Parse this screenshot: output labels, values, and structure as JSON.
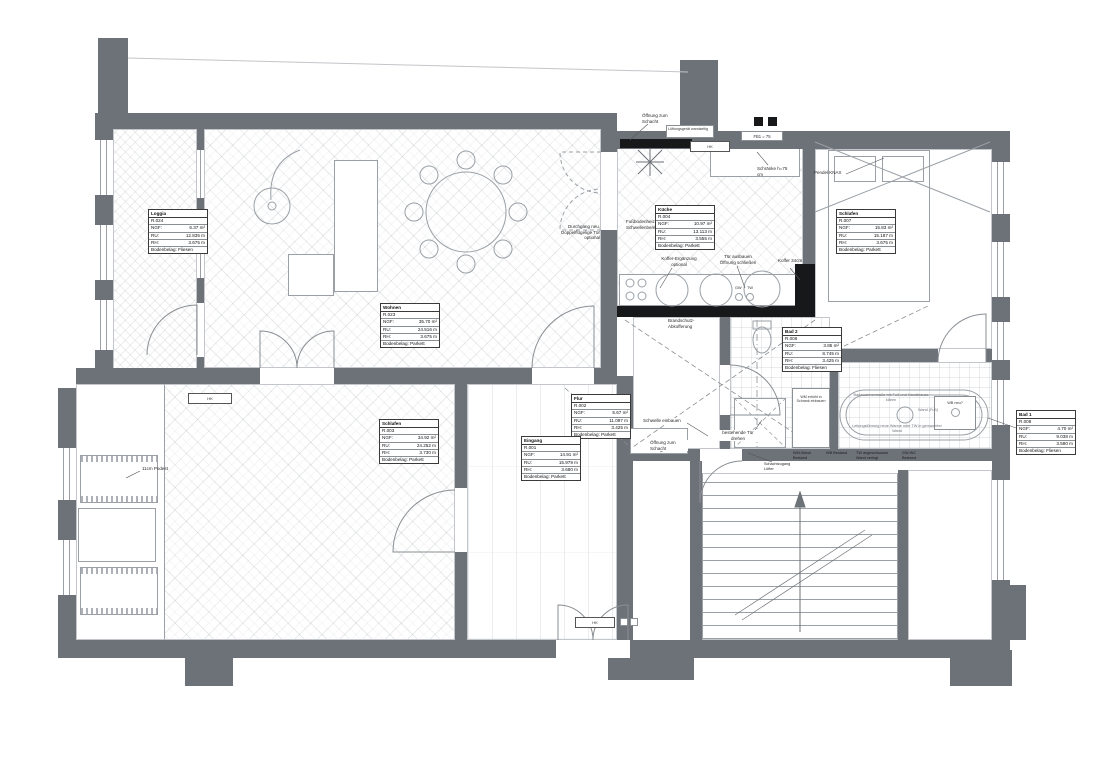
{
  "drawing": {
    "type": "floor-plan",
    "language": "de",
    "wall_color": "#6d7178",
    "accent_black": "#17181a"
  },
  "metrics_labels": {
    "ngf": "NGF:",
    "ru": "RU:",
    "rh": "RH:"
  },
  "rooms": [
    {
      "name": "Loggia",
      "number": "R.024",
      "ngf": "6.37 m²",
      "ru": "12.835 m",
      "rh": "3.675 m",
      "floor": "Bodenbelag: Fliesen"
    },
    {
      "name": "Wohnen",
      "number": "R.023",
      "ngf": "35.70 m²",
      "ru": "24.516 m",
      "rh": "3.675 m",
      "floor": "Bodenbelag: Parkett"
    },
    {
      "name": "Küche",
      "number": "R.004",
      "ngf": "10.97 m²",
      "ru": "13.113 m",
      "rh": "3.555 m",
      "floor": "Bodenbelag: Parkett"
    },
    {
      "name": "Schlafen",
      "number": "R.007",
      "ngf": "15.83 m²",
      "ru": "15.187 m",
      "rh": "3.675 m",
      "floor": "Bodenbelag: Parkett"
    },
    {
      "name": "Bad 2",
      "number": "R.006",
      "ngf": "3.85 m²",
      "ru": "8.745 m",
      "rh": "3.425 m",
      "floor": "Bodenbelag: Fliesen"
    },
    {
      "name": "Flur",
      "number": "R.002",
      "ngf": "5.67 m²",
      "ru": "11.097 m",
      "rh": "3.425 m",
      "floor": "Bodenbelag: Parkett"
    },
    {
      "name": "Eingang",
      "number": "R.001",
      "ngf": "14.91 m²",
      "ru": "15.979 m",
      "rh": "3.680 m",
      "floor": "Bodenbelag: Parkett"
    },
    {
      "name": "Schlafen",
      "number": "R.003",
      "ngf": "34.92 m²",
      "ru": "24.252 m",
      "rh": "3.730 m",
      "floor": "Bodenbelag: Parkett"
    },
    {
      "name": "Bad 1",
      "number": "R.008",
      "ngf": "4.70 m²",
      "ru": "9.038 m",
      "rh": "3.580 m",
      "floor": "Bodenbelag: Fliesen"
    }
  ],
  "annotations": {
    "oeffnung_schacht_top": "Öffnung zum Schacht",
    "lueftung": "Lüftungsgerät wandseitig",
    "hk": "HK",
    "fb1": "FB1 = 75",
    "schraenke": "Schränke h=75 cm",
    "pendel_knax": "Pendel KNAX",
    "fussbodenheizung": "Fußbodenheizung im Schwellenbereich",
    "durchgang": "Durchgang neu, Doppelflügelige Tür optional",
    "koffer_ergaenzung": "Koffer-Ergänzung optional",
    "tuer_ausbauen": "Tür ausbauen Öffnung schließen",
    "koffer_34": "Koffer 34cm",
    "gw": "GW",
    "tw": "TW",
    "brandschutz": "Brandschutz-Abkofferung",
    "schwelle": "Schwelle einbauen",
    "oeffnung_schacht_flur": "Öffnung zum Schacht",
    "tuer_drehen": "bestehende Tür drehen",
    "podest": "11cm Podest",
    "wm_schrank": "WM erhöht in Schrank einbauen",
    "badewanne": "Badewannenmaße mit Fuß und Handbrause klären",
    "wand_fuss": "Wand (Fuß)",
    "leitungsfuehrung": "Leitungsführung neue Wanne oder TW in gemauerter Wand",
    "wb_neu": "WB neu?",
    "wm_wand_bestand": "WM-Wand Bestand",
    "wb_bestand": "WB Bestand",
    "tw_wand": "TW angeschlossen Wand verlegt",
    "gw_wc_bestand": "GW-WC Bestand",
    "schachtzugang": "Schachtzugang Lüfter"
  }
}
